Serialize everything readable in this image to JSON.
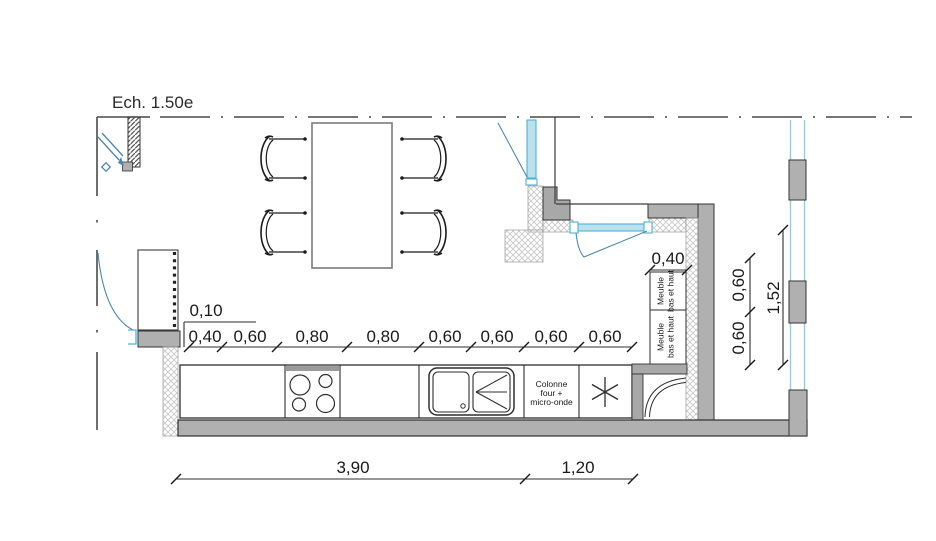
{
  "scale_label": "Ech. 1.50e",
  "dims": {
    "offset": "0,10",
    "counter": [
      "0,40",
      "0,60",
      "0,80",
      "0,80",
      "0,60",
      "0,60",
      "0,60",
      "0,60"
    ],
    "cabinet": "0,40",
    "right": [
      "0,60",
      "0,60",
      "1,52"
    ],
    "bottom": [
      "3,90",
      "1,20"
    ]
  },
  "labels": {
    "cabinet1": [
      "Meuble",
      "bas et haut"
    ],
    "cabinet2": [
      "Meuble",
      "bas et haut"
    ],
    "column": [
      "Colonne",
      "four +",
      "micro-onde"
    ]
  },
  "colors": {
    "wall_fill": "#b0b0b0",
    "line": "#3c3c3c",
    "dim_text": "#1a1a1a",
    "glazing_fill": "#b9e2ee",
    "glazing_edge": "#53b1cf",
    "door_swing": "#4e86ad",
    "insulation_hatch": "#c9c9c9"
  }
}
